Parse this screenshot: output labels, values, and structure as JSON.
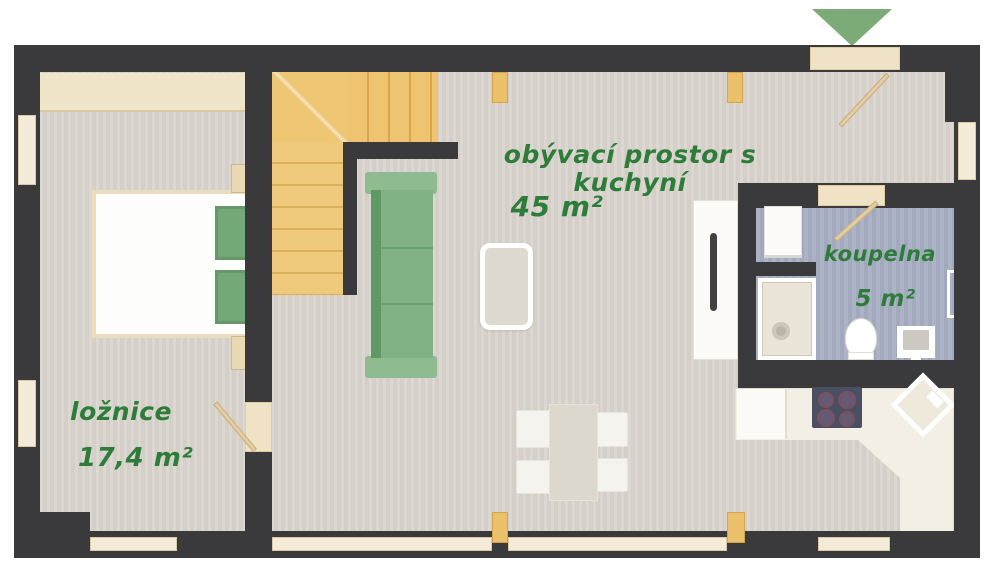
{
  "plan": {
    "rooms": {
      "living": {
        "name": "obývací prostor s kuchyní",
        "area": "45 m²"
      },
      "bedroom": {
        "name": "ložnice",
        "area": "17,4 m²"
      },
      "bathroom": {
        "name": "koupelna",
        "area": "5 m²"
      }
    },
    "icons": {
      "entrance": "entrance-arrow-icon"
    },
    "colors": {
      "wall": "#3a3a3c",
      "floor": "#d8d3cc",
      "bathroom_floor": "#a7aec3",
      "stairs_wood": "#eec674",
      "label_green": "#2e7c3a",
      "furniture_green": "#81b185",
      "entrance_arrow_green": "#7cab77"
    }
  }
}
